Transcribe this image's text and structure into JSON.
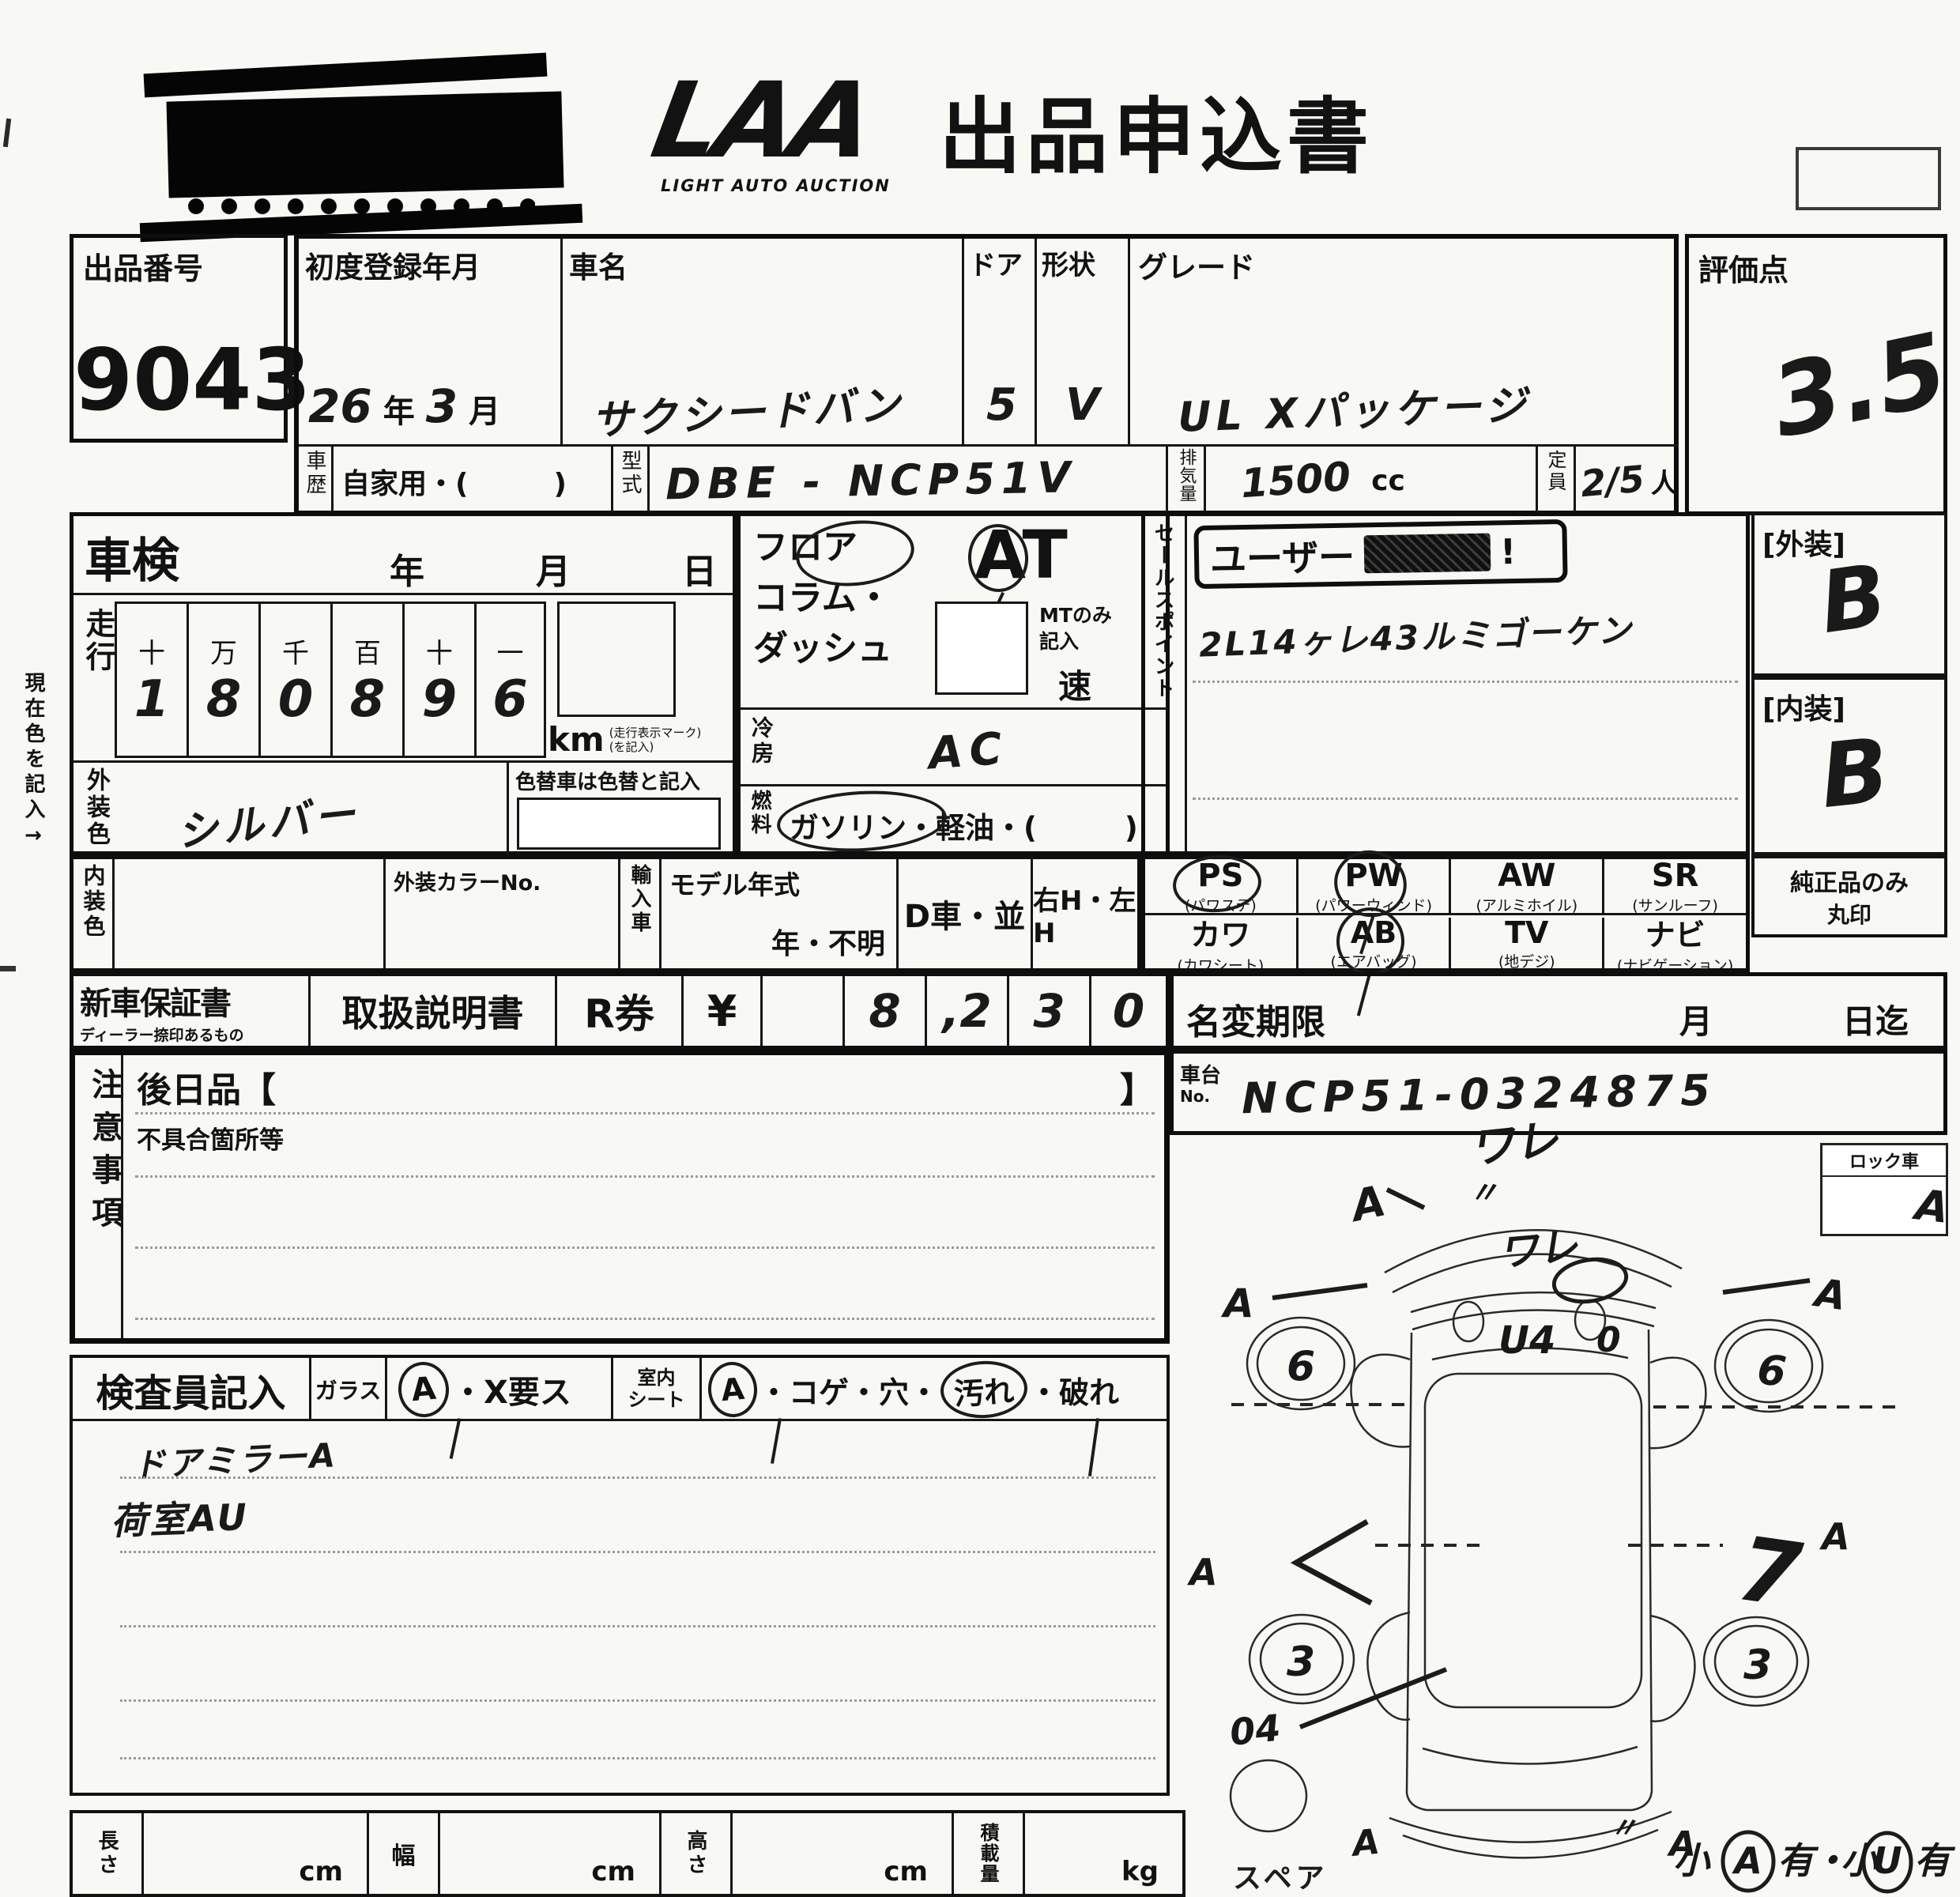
{
  "page": {
    "title": "出品申込書",
    "logo": "LAA",
    "logo_sub": "LIGHT AUTO AUCTION"
  },
  "lot": {
    "label": "出品番号",
    "value": "9043"
  },
  "row1": {
    "first_reg_label": "初度登録年月",
    "first_reg_year": "26",
    "year_unit": "年",
    "first_reg_month": "3",
    "month_unit": "月",
    "name_label": "車名",
    "name_value": "サクシードバン",
    "door_label": "ドア",
    "door_value": "5",
    "shape_label": "形状",
    "shape_value": "V",
    "grade_label": "グレード",
    "grade_value": "UL Xパッケージ",
    "score_label": "評価点",
    "score_value": "3.5"
  },
  "row2": {
    "history_label": "車歴",
    "history_value": "自家用・(　　　)",
    "model_label": "型式",
    "model_value": "DBE - NCP51V",
    "disp_label": "排気量",
    "disp_value": "1500",
    "disp_unit": "cc",
    "cap_label": "定員",
    "cap_value": "2/5",
    "cap_unit": "人"
  },
  "shaken": {
    "label": "車検",
    "year": "年",
    "month": "月",
    "day": "日"
  },
  "mileage": {
    "label": "走行",
    "headers": [
      "十",
      "万",
      "千",
      "百",
      "十",
      "一"
    ],
    "digits": [
      "1",
      "8",
      "0",
      "8",
      "9",
      "6"
    ],
    "unit": "km",
    "note1": "(走行表示マーク)",
    "note2": "(を記入)"
  },
  "ext_color": {
    "label": "外装色",
    "value": "シルバー",
    "recolor_note": "色替車は色替と記入"
  },
  "int_color": {
    "label": "内装色",
    "color_no_label": "外装カラーNo.",
    "import_label": "輸入車",
    "model_year_label": "モデル年式",
    "model_year_note": "年・不明",
    "dealer": "D車・並",
    "handle": "右H・左H"
  },
  "margin_note": "現在色を記入→",
  "trans": {
    "l1": "フロア",
    "l2": "コラム・",
    "l3": "ダッシュ",
    "at": "AT",
    "mt1": "MTのみ",
    "mt2": "記入",
    "speed": "速"
  },
  "cool": {
    "label": "冷房",
    "value": "AC"
  },
  "fuel": {
    "label": "燃料",
    "value": "ガソリン・軽油・(　　　)"
  },
  "sales": {
    "label": "セールスポイント",
    "stamp": "ユーザー",
    "stamp_mark": "!",
    "note": "2L14ヶレ43ルミゴーケン"
  },
  "equip": {
    "r1": [
      {
        "code": "PS",
        "name": "(パワステ)"
      },
      {
        "code": "PW",
        "name": "(パワーウィンド)"
      },
      {
        "code": "AW",
        "name": "(アルミホイル)"
      },
      {
        "code": "SR",
        "name": "(サンルーフ)"
      }
    ],
    "r2": [
      {
        "code": "カワ",
        "name": "(カワシート)"
      },
      {
        "code": "AB",
        "name": "(エアバッグ)"
      },
      {
        "code": "TV",
        "name": "(地デジ)"
      },
      {
        "code": "ナビ",
        "name": "(ナビゲーション)"
      }
    ]
  },
  "cond": {
    "ext_label": "[外装]",
    "ext_value": "B",
    "int_label": "[内装]",
    "int_value": "B",
    "genuine1": "純正品のみ",
    "genuine2": "丸印"
  },
  "docs": {
    "warranty": "新車保証書",
    "warranty_sub": "ディーラー捺印あるもの",
    "manual": "取扱説明書",
    "rticket": "R券",
    "yen": "¥",
    "amount": [
      "",
      "8",
      ",2",
      "3",
      "0"
    ]
  },
  "transfer": {
    "label": "名変期限",
    "month": "月",
    "day": "日迄"
  },
  "chassis": {
    "label1": "車台",
    "label2": "No.",
    "value": "NCP51-0324875"
  },
  "lock": {
    "label": "ロック車"
  },
  "notes": {
    "label": "注意事項",
    "later": "後日品【",
    "later_close": "】",
    "defect": "不具合箇所等"
  },
  "inspector": {
    "label": "検査員記入",
    "glass_label": "ガラス",
    "glass_a": "A",
    "glass_rest": "・X要ス",
    "seat_label1": "室内",
    "seat_label2": "シート",
    "seat_a": "A",
    "seat_mid": "・コゲ・穴・",
    "seat_stain": "汚れ",
    "seat_rest": "・破れ",
    "note1": "ドアミラーA",
    "note2": "荷室AU"
  },
  "diagram": {
    "lock_label": "ロック車",
    "crack_top": "ワレ",
    "ditto": "〃",
    "crack_glass": "ワレ",
    "roof_mark": "U4",
    "zero": "0",
    "a": "A",
    "front_wheel": "6",
    "rear_wheel": "3",
    "arrow_right": "7",
    "lower_left": "04",
    "spare": "スペア",
    "legend": {
      "s1": "小",
      "a": "A",
      "y1": "有",
      "dot": "・",
      "s2": "小",
      "u": "U",
      "y2": "有"
    }
  },
  "dims": {
    "length": "長さ",
    "width": "幅",
    "height": "高さ",
    "load": "積載量",
    "cm": "cm",
    "kg": "kg"
  }
}
